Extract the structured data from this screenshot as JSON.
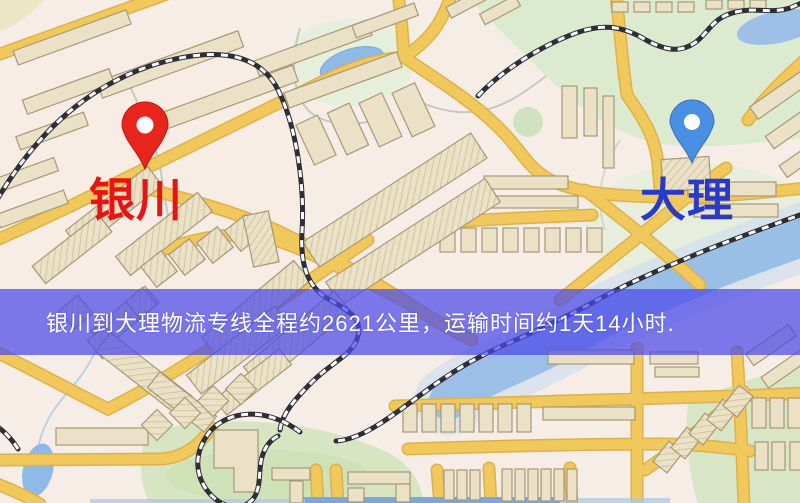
{
  "banner": {
    "text": "银川到大理物流专线全程约2621公里，运输时间约1天14小时.",
    "background_color": "#4b4ae9",
    "text_color": "#ffffff"
  },
  "route": {
    "origin": "银川",
    "destination": "大理",
    "distance": "约2621公里",
    "duration": "约1天14小时"
  },
  "markers": {
    "origin": {
      "label": "银川",
      "pin_color": "#e8251d",
      "label_color": "#e91313"
    },
    "destination": {
      "label": "大理",
      "pin_color": "#4a90e2",
      "label_color": "#2a3ac8"
    }
  },
  "map": {
    "colors": {
      "background": "#f6eee6",
      "tint": "#f8ebe5",
      "road": "#f0c85c",
      "road_casing": "#ddb14b",
      "building": "#eae1c6",
      "building_outline": "#a79877",
      "park": "#d7e5c2",
      "park_light": "#e3edd9",
      "water": "#8fb9e6",
      "water_light": "#c6daf0",
      "railway_dark": "#2e2e36",
      "railway_light": "#ffffff"
    }
  }
}
